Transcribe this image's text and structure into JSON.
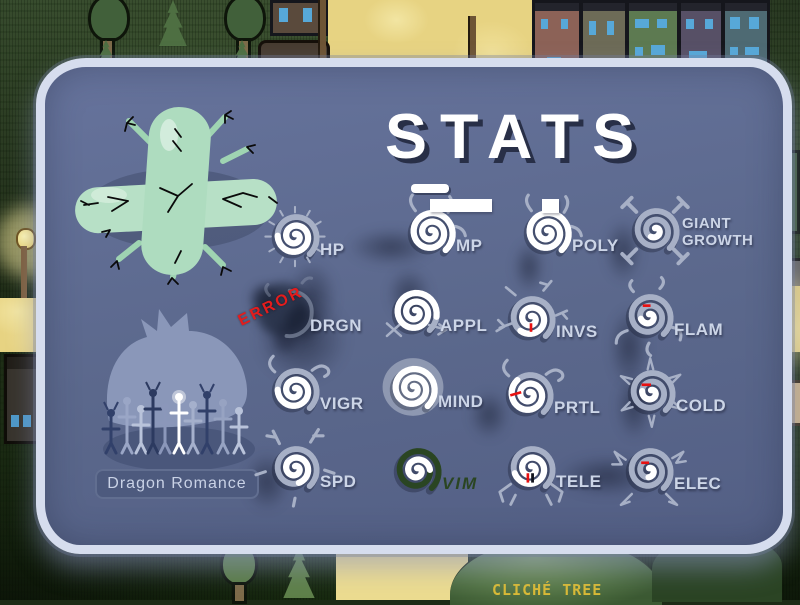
{
  "title": {
    "text": "STATS"
  },
  "stats": {
    "error_label": "ERROR",
    "items": [
      {
        "label": "HP",
        "fill": 0.58,
        "deco": "thorns"
      },
      {
        "label": "MP",
        "fill": 1.0,
        "deco": "sprouts"
      },
      {
        "label": "POLY",
        "fill": 1.0,
        "deco": "sprouts"
      },
      {
        "label": "GIANT GROWTH",
        "fill": 0.1,
        "deco": "stubs"
      },
      {
        "label": "DRGN",
        "fill": 0.0,
        "deco": "smoke"
      },
      {
        "label": "APPL",
        "fill": 0.92,
        "deco": "arrows"
      },
      {
        "label": "INVS",
        "fill": 0.5,
        "deco": "branches",
        "red": [
          50,
          58,
          50,
          69
        ]
      },
      {
        "label": "FLAM",
        "fill": 0.13,
        "deco": "flames",
        "red": [
          42,
          38,
          52,
          38
        ]
      },
      {
        "label": "VIGR",
        "fill": 0.58,
        "deco": "curls"
      },
      {
        "label": "MIND",
        "fill": 1.0,
        "deco": "blob"
      },
      {
        "label": "PRTL",
        "fill": 0.66,
        "deco": "curls",
        "red": [
          26,
          53,
          40,
          49
        ]
      },
      {
        "label": "COLD",
        "fill": 0.15,
        "deco": "snow",
        "red": [
          38,
          42,
          50,
          42
        ]
      },
      {
        "label": "SPD",
        "fill": 0.42,
        "deco": "antlers"
      },
      {
        "label": "VIM",
        "fill": 0.32,
        "deco": "none",
        "theme": "green"
      },
      {
        "label": "TELE",
        "fill": 0.55,
        "deco": "legs",
        "red": [
          46,
          58,
          46,
          70
        ],
        "black": [
          52,
          58,
          52,
          70
        ]
      },
      {
        "label": "ELEC",
        "fill": 0.08,
        "deco": "bolts",
        "red": [
          40,
          42,
          50,
          42
        ]
      }
    ]
  },
  "poster": {
    "caption": "Dragon Romance"
  },
  "background": {
    "tree_label": "CLICHÉ TREE",
    "sign_text": "N"
  },
  "colors": {
    "panel_bg": "#5e6b8e",
    "panel_border": "#d6ddee",
    "spiral_grey": "#a7b0c6",
    "fill_white": "#ffffff",
    "stat_label": "#ccd5e7",
    "error_red": "#e41c1c",
    "vim_green": "#2a4522",
    "red_tick": "#e81010",
    "path_yellow": "#e7d382",
    "tree_label_yellow": "#d9ba36"
  }
}
